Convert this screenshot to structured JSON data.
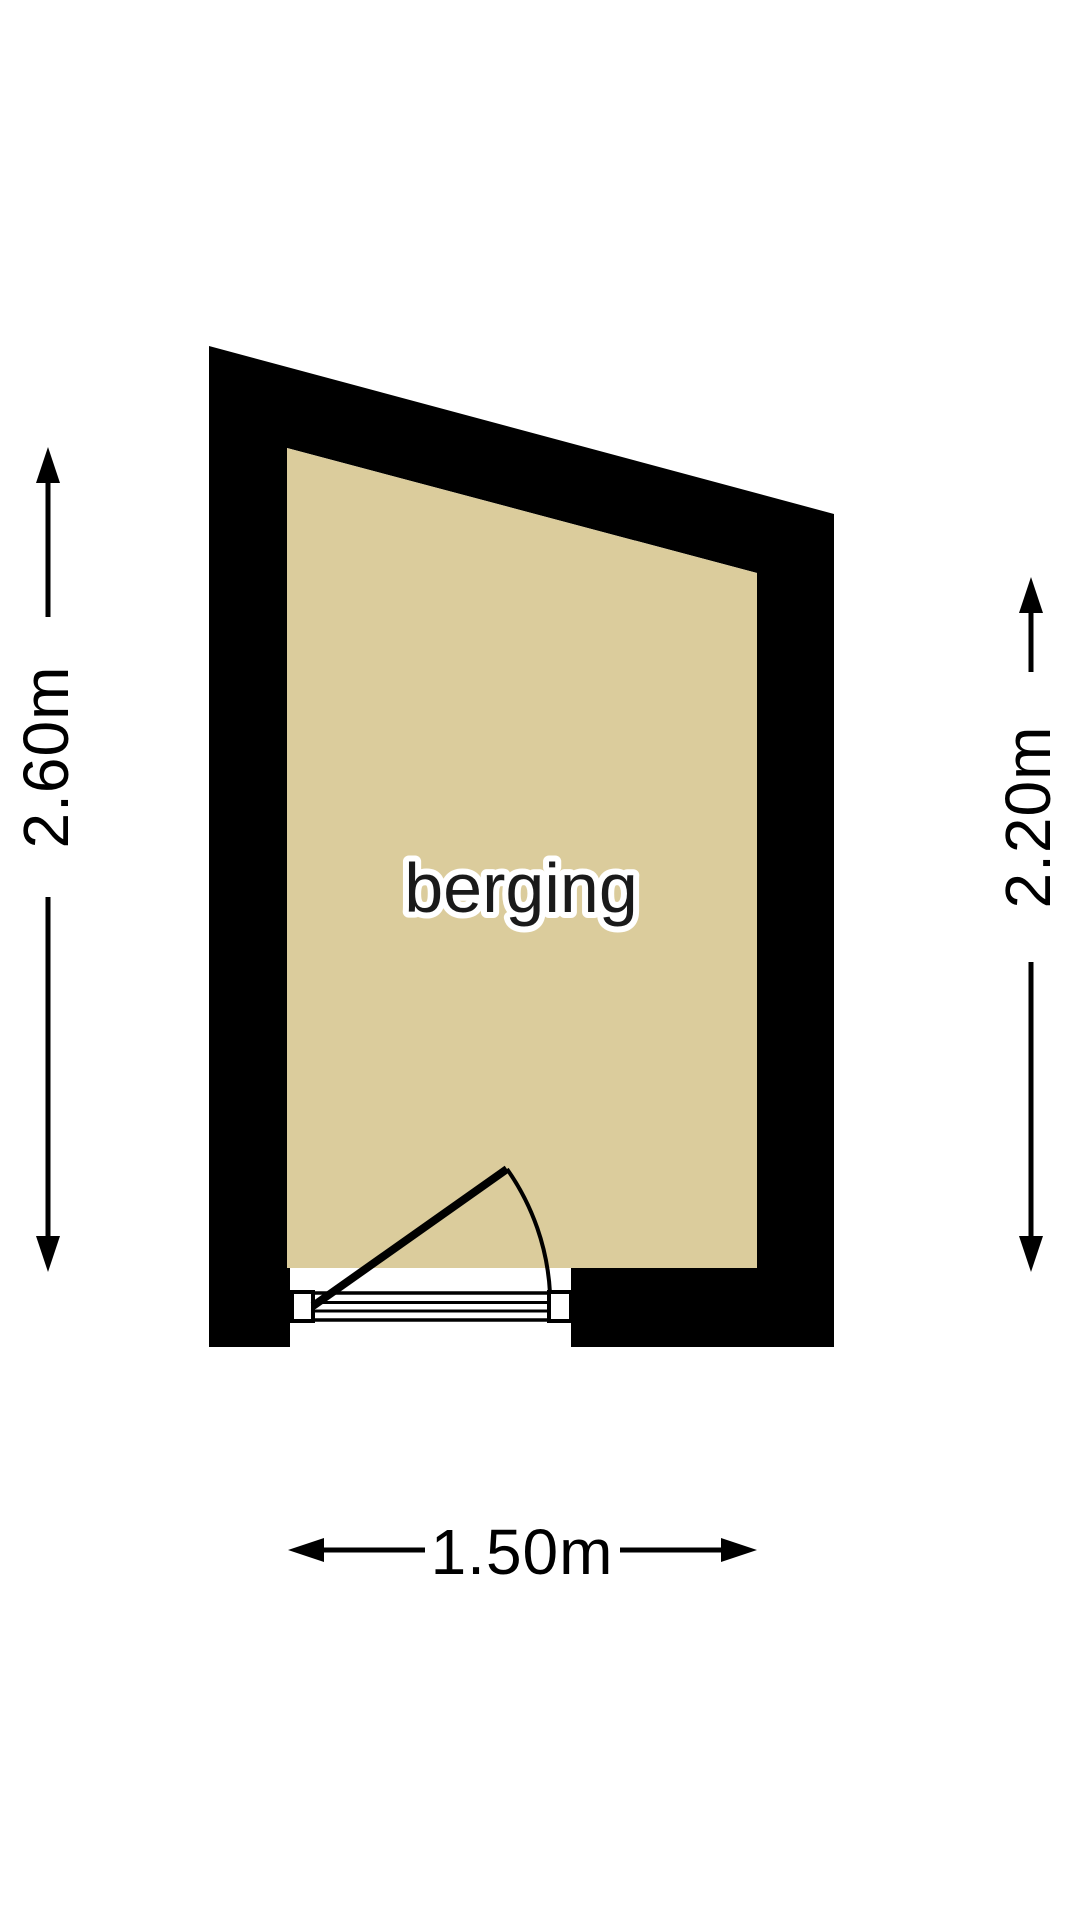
{
  "plan": {
    "room": {
      "label": "berging"
    },
    "dimensions": {
      "left": {
        "label": "2.60m"
      },
      "right": {
        "label": "2.20m"
      },
      "bottom": {
        "label": "1.50m"
      }
    },
    "colors": {
      "wall": "#000000",
      "floor": "#dbcc9c",
      "background": "#ffffff",
      "dimension_text": "#000000",
      "room_label_text": "#1a1a1a",
      "room_label_halo": "#ffffff"
    }
  }
}
